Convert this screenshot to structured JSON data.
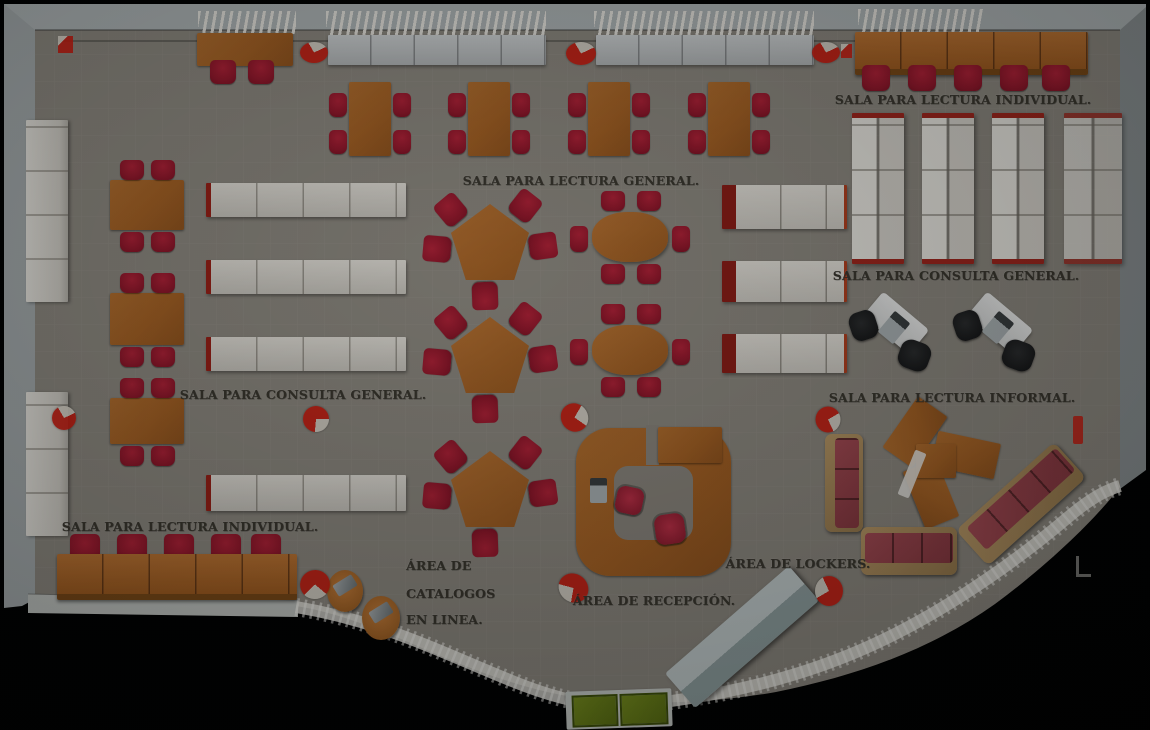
{
  "scene": {
    "type": "library floor plan, top-down 3D render",
    "language": "es"
  },
  "labels": {
    "reading_individual_top": "SALA PARA LECTURA INDIVIDUAL.",
    "reading_general": "SALA PARA LECTURA GENERAL.",
    "consult_general_right": "SALA PARA CONSULTA GENERAL.",
    "consult_general_left": "SALA PARA CONSULTA GENERAL.",
    "reading_informal": "SALA PARA LECTURA INFORMAL.",
    "reading_individual_bottom": "SALA PARA LECTURA INDIVIDUAL.",
    "catalogs_line1": "ÁREA DE",
    "catalogs_line2": "CATALOGOS",
    "catalogs_line3": "EN LINEA.",
    "reception": "ÁREA DE RECEPCIÓN.",
    "lockers": "ÁREA DE LOCKERS."
  },
  "palette": {
    "background": "#000000",
    "floor": "#8f8b82",
    "walls": "#b2b9ba",
    "wood_tables": "#b06a2b",
    "chairs_red": "#a31c30",
    "shelves_white": "#e0ddd5",
    "shelf_ends_red": "#9c1f16",
    "sofa_red": "#a04a52",
    "sofa_frame_tan": "#b18f60",
    "lockers_gray": "#b9c4c4",
    "entrance_mat_green": "#6d8418",
    "fire_marker_red": "#ce1d10",
    "label_text": "#3b382f"
  },
  "icons": {
    "fire_extinguisher_marker": "red circle with white quarter notch",
    "corner_mark": "white L-shaped mark"
  }
}
